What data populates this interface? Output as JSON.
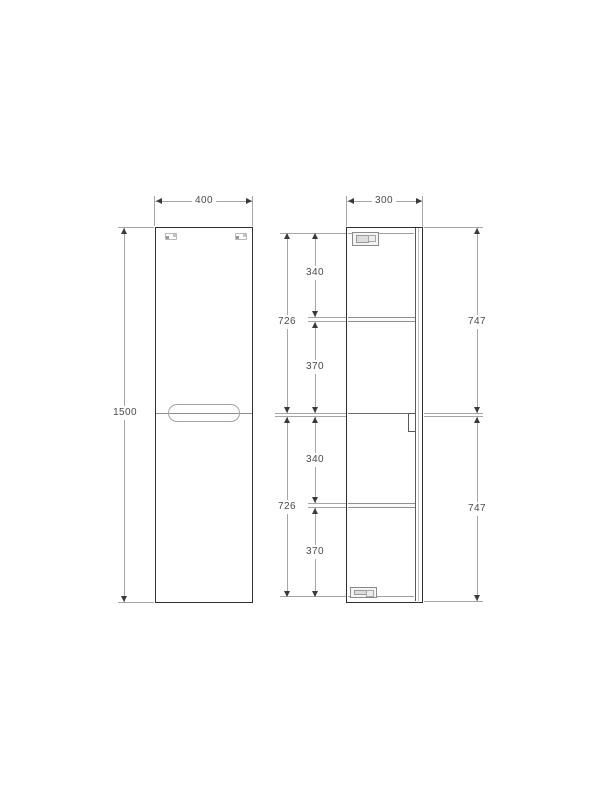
{
  "drawing": {
    "front_view": {
      "width_mm": "400",
      "height_mm": "1500"
    },
    "side_view": {
      "depth_mm": "300",
      "upper_section": {
        "top_to_shelf": "340",
        "shelf_to_divider": "370",
        "interior_height": "726",
        "overall_height": "747"
      },
      "lower_section": {
        "divider_to_shelf": "340",
        "shelf_to_bottom": "370",
        "interior_height": "726",
        "overall_height": "747"
      }
    },
    "colors": {
      "outline": "#2f2f2f",
      "dimension_line": "#a6a6a6",
      "text": "#4a4a4a",
      "background": "#ffffff"
    }
  }
}
